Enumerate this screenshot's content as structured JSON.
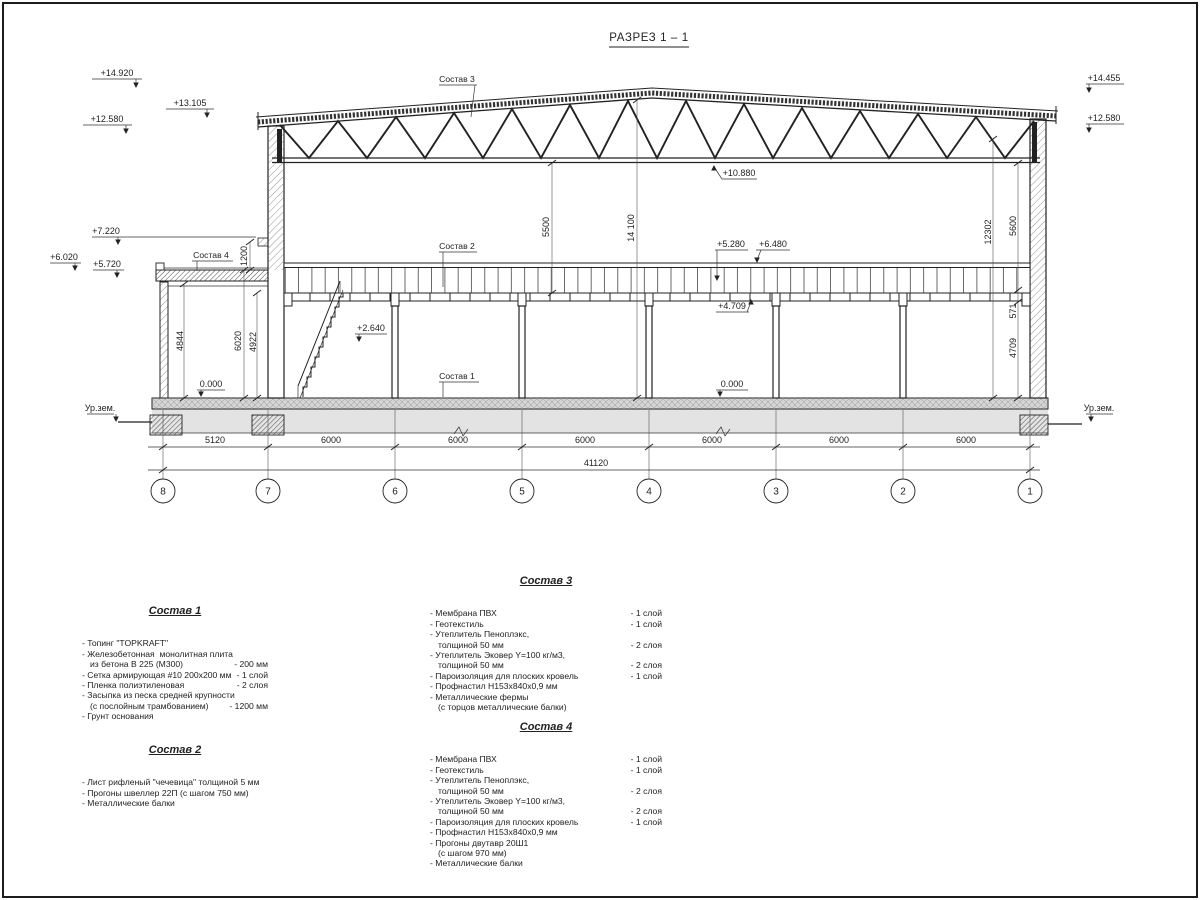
{
  "title": "РАЗРЕЗ 1 – 1",
  "colors": {
    "ink": "#222222",
    "slab_gray": "#d4d4d4",
    "ground_gray": "#e3e3e3"
  },
  "marks": {
    "m14920": "+14.920",
    "m13105": "+13.105",
    "m12580l": "+12.580",
    "m7220": "+7.220",
    "m6020": "+6.020",
    "m5720": "+5.720",
    "m14455": "+14.455",
    "m12580r": "+12.580",
    "m10880": "+10.880",
    "m5280": "+5.280",
    "m6480": "+6.480",
    "m4709": "+4.709",
    "m2640": "+2.640",
    "zero_l": "0.000",
    "zero_c": "0.000",
    "urzem_l": "Ур.зем.",
    "urzem_r": "Ур.зем."
  },
  "dims": {
    "d5500": "5500",
    "d14100": "14 100",
    "d12302": "12302",
    "d5600": "5600",
    "d571": "571",
    "d4709": "4709",
    "d4844": "4844",
    "d6020": "6020",
    "d4922": "4922",
    "d1200": "1200",
    "bottom": [
      "5120",
      "6000",
      "6000",
      "6000",
      "6000",
      "6000",
      "6000"
    ],
    "total": "41120"
  },
  "grids": [
    "8",
    "7",
    "6",
    "5",
    "4",
    "3",
    "2",
    "1"
  ],
  "leaders": {
    "sostav1": "Состав 1",
    "sostav2": "Состав 2",
    "sostav3": "Состав 3",
    "sostav4": "Состав 4"
  },
  "comps": [
    {
      "heading": "Состав 1",
      "items": [
        {
          "t": "- Топинг \"TOPKRAFT\""
        },
        {
          "t": "- Железобетонная  монолитная плита"
        },
        {
          "t": "из бетона В 225 (М300)",
          "v": "- 200 мм"
        },
        {
          "t": "- Сетка армирующая #10 200x200 мм",
          "v": "- 1 слой"
        },
        {
          "t": "- Пленка полиэтиленовая",
          "v": "- 2 слоя"
        },
        {
          "t": "- Засыпка из песка средней крупности"
        },
        {
          "t": "(с послойным трамбованием)",
          "v": "- 1200 мм"
        },
        {
          "t": "- Грунт основания"
        }
      ]
    },
    {
      "heading": "Состав 2",
      "items": [
        {
          "t": "- Лист рифленый \"чечевица\" толщиной 5 мм"
        },
        {
          "t": "- Прогоны швеллер 22П (с шагом 750 мм)"
        },
        {
          "t": "- Металлические балки"
        }
      ]
    },
    {
      "heading": "Состав 3",
      "items": [
        {
          "t": "- Мембрана ПВХ",
          "v": "- 1 слой"
        },
        {
          "t": "- Геотекстиль",
          "v": "- 1 слой"
        },
        {
          "t": "- Утеплитель Пеноплэкс,"
        },
        {
          "t": "толщиной 50 мм",
          "v": "- 2 слоя"
        },
        {
          "t": "- Утеплитель Эковер Y=100 кг/м3,"
        },
        {
          "t": "толщиной 50 мм",
          "v": "- 2 слоя"
        },
        {
          "t": "- Пароизоляция для плоских кровель",
          "v": "- 1 слой"
        },
        {
          "t": "- Профнастил Н153х840х0,9 мм"
        },
        {
          "t": "- Металлические фермы"
        },
        {
          "t": "(с торцов металлические балки)"
        }
      ]
    },
    {
      "heading": "Состав 4",
      "items": [
        {
          "t": "- Мембрана ПВХ",
          "v": "- 1 слой"
        },
        {
          "t": "- Геотекстиль",
          "v": "- 1 слой"
        },
        {
          "t": "- Утеплитель Пеноплэкс,"
        },
        {
          "t": "толщиной 50 мм",
          "v": "- 2 слоя"
        },
        {
          "t": "- Утеплитель Эковер Y=100 кг/м3,"
        },
        {
          "t": "толщиной 50 мм",
          "v": "- 2 слоя"
        },
        {
          "t": "- Пароизоляция для плоских кровель",
          "v": "- 1 слой"
        },
        {
          "t": "- Профнастил Н153х840х0,9 мм"
        },
        {
          "t": "- Прогоны двутавр 20Ш1"
        },
        {
          "t": "(с шагом 970 мм)"
        },
        {
          "t": "- Металлические балки"
        }
      ]
    }
  ]
}
